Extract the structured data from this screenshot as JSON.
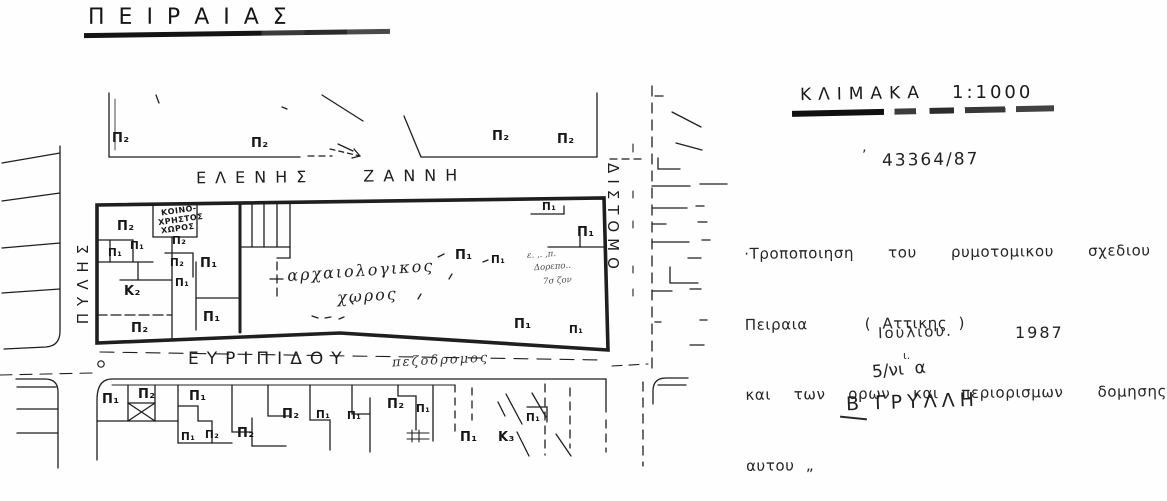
{
  "title": "ΠΕΙΡΑΙΑΣ",
  "map": {
    "streets": {
      "north": "ΕΛΕΝΗΣ ΖΑΝΝΗ",
      "south": "ΕΥΡΙΠΙΔΟΥ",
      "south_note": "πεζοδρομος",
      "west": "ΠΥΛΗΣ",
      "east": "ΔΙΣΤΟΜΟ"
    },
    "area_label": {
      "line1": "αρχαιολογικος",
      "line2": "χωρος"
    },
    "common_space": [
      "ΚΟΙΝΟ-",
      "ΧΡΗΣΤΟΣ",
      "ΧΩΡΟΣ"
    ],
    "scribble": [
      "ε. ,. ,π.",
      "Δορεπο..",
      "7σ ζον"
    ],
    "zone_labels": [
      {
        "text": "Π₂",
        "x": 112,
        "y": 131
      },
      {
        "text": "Π₂",
        "x": 251,
        "y": 136
      },
      {
        "text": "Π₂",
        "x": 492,
        "y": 129
      },
      {
        "text": "Π₂",
        "x": 557,
        "y": 132
      },
      {
        "text": "Π₂",
        "x": 117,
        "y": 219
      },
      {
        "text": "Π₂",
        "x": 172,
        "y": 235,
        "small": true
      },
      {
        "text": "Π₁",
        "x": 130,
        "y": 240,
        "small": true
      },
      {
        "text": "Π₁",
        "x": 108,
        "y": 247,
        "small": true
      },
      {
        "text": "Π₂",
        "x": 170,
        "y": 257,
        "small": true
      },
      {
        "text": "Π₁",
        "x": 200,
        "y": 256
      },
      {
        "text": "Π₁",
        "x": 175,
        "y": 277,
        "small": true
      },
      {
        "text": "Κ₂",
        "x": 124,
        "y": 284
      },
      {
        "text": "Π₁",
        "x": 203,
        "y": 310
      },
      {
        "text": "Π₂",
        "x": 131,
        "y": 321
      },
      {
        "text": "Π₁",
        "x": 542,
        "y": 201,
        "small": true
      },
      {
        "text": "Π₁",
        "x": 577,
        "y": 225
      },
      {
        "text": "Π₁",
        "x": 455,
        "y": 248
      },
      {
        "text": "Π₁",
        "x": 491,
        "y": 254,
        "small": true
      },
      {
        "text": "Π₁",
        "x": 514,
        "y": 317
      },
      {
        "text": "Π₁",
        "x": 569,
        "y": 324,
        "small": true
      },
      {
        "text": "Π₁",
        "x": 102,
        "y": 392
      },
      {
        "text": "Π₂",
        "x": 138,
        "y": 387
      },
      {
        "text": "Π₁",
        "x": 189,
        "y": 389
      },
      {
        "text": "Π₁",
        "x": 181,
        "y": 431,
        "small": true
      },
      {
        "text": "Π₂",
        "x": 205,
        "y": 429,
        "small": true
      },
      {
        "text": "Π₂",
        "x": 237,
        "y": 426
      },
      {
        "text": "Π₂",
        "x": 282,
        "y": 407
      },
      {
        "text": "Π₁",
        "x": 316,
        "y": 409,
        "small": true
      },
      {
        "text": "Π₁",
        "x": 347,
        "y": 410,
        "small": true
      },
      {
        "text": "Π₂",
        "x": 387,
        "y": 397
      },
      {
        "text": "Π₁",
        "x": 416,
        "y": 403,
        "small": true
      },
      {
        "text": "Π₁",
        "x": 460,
        "y": 430
      },
      {
        "text": "Κ₃",
        "x": 498,
        "y": 430
      },
      {
        "text": "Π₁",
        "x": 526,
        "y": 412,
        "small": true
      }
    ]
  },
  "annotations": {
    "scale_label": "ΚΛΙΜΑΚΑ",
    "scale_value": "1:1000",
    "reference_mark": "’",
    "reference_number": "43364/87",
    "note_lines": [
      "·Τροποποιηση   του   ρυμοτομικου   σχεδιου",
      "Πειραια     ( Αττικης )",
      "και  των  ορων  και  περιορισμων   δομησης",
      "αυτου „"
    ],
    "date_month": "Ιουλιου.",
    "date_year": "1987",
    "small_mark": "ι.",
    "file_ref": "5/νι  α",
    "signature": "Β ΓΡΥΛΛΗ"
  },
  "ink_color": "#1b1b1b"
}
